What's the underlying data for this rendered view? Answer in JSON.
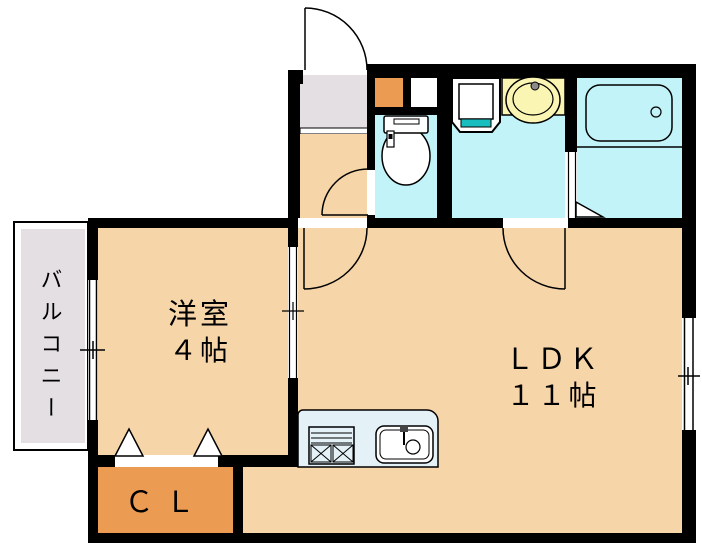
{
  "plan": {
    "type": "apartment-floor-plan",
    "rooms": {
      "balcony": {
        "label": "バルコニー"
      },
      "western_room": {
        "name": "洋室",
        "size": "４帖"
      },
      "ldk": {
        "name": "ＬＤＫ",
        "size": "１１帖"
      },
      "closet": {
        "label": "ＣＬ"
      }
    },
    "fixtures": [
      "entrance-door",
      "shoe-cabinet",
      "toilet",
      "washing-machine-pan",
      "wash-basin",
      "bathtub",
      "bathroom-folding-door",
      "kitchen-counter",
      "gas-stove",
      "kitchen-sink",
      "closet-folding-doors",
      "windows"
    ],
    "colors": {
      "floor": "#F6D5A9",
      "closet_accent": "#EC9B52",
      "wet_area": "#C2F3F8",
      "counter": "#E4F2F8",
      "basin_unit": "#FBF5B3",
      "pan_drain": "#18BEBE",
      "balcony_gray": "#E3DFE2",
      "wall": "#000000",
      "background": "#FFFFFF"
    }
  }
}
